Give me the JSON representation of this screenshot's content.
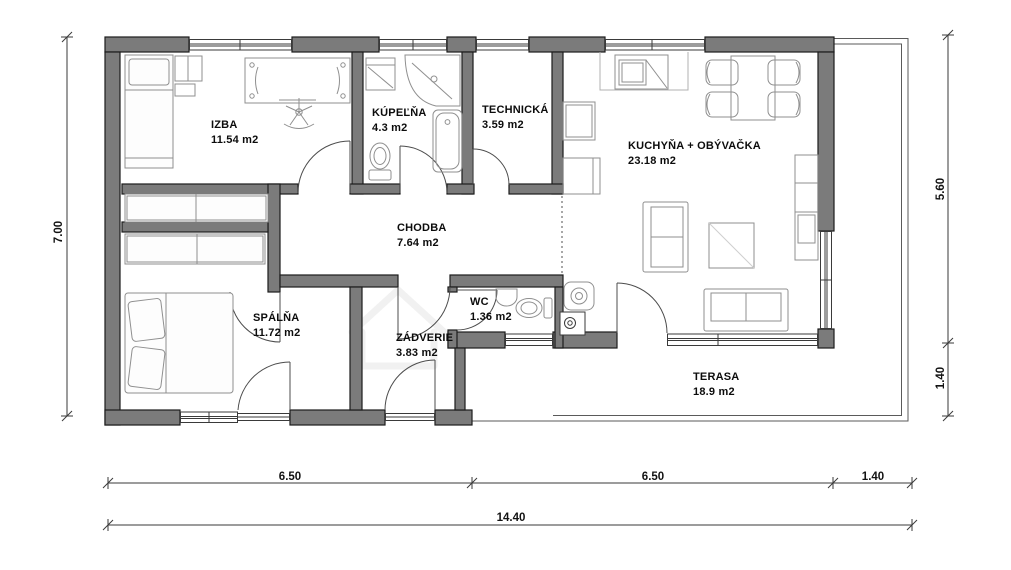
{
  "plan": {
    "title": "family-house floor plan",
    "rooms": [
      {
        "id": "izba",
        "name": "IZBA",
        "area": "11.54 m2"
      },
      {
        "id": "kupelna",
        "name": "KÚPEĽŇA",
        "area": "4.3 m2"
      },
      {
        "id": "technicka",
        "name": "TECHNICKÁ",
        "area": "3.59 m2"
      },
      {
        "id": "kuchyna",
        "name": "KUCHYŇA + OBÝVAČKA",
        "area": "23.18 m2"
      },
      {
        "id": "chodba",
        "name": "CHODBA",
        "area": "7.64 m2"
      },
      {
        "id": "spalna",
        "name": "SPÁLŇA",
        "area": "11.72 m2"
      },
      {
        "id": "wc",
        "name": "WC",
        "area": "1.36 m2"
      },
      {
        "id": "zadverie",
        "name": "ZÁDVERIE",
        "area": "3.83 m2"
      },
      {
        "id": "terasa",
        "name": "TERASA",
        "area": "18.9 m2"
      }
    ],
    "dimensions": {
      "left_height": "7.00",
      "right_upper": "5.60",
      "right_lower": "1.40",
      "bottom_left": "6.50",
      "bottom_middle": "6.50",
      "bottom_right": "1.40",
      "bottom_total": "14.40"
    },
    "colors": {
      "wall": "#7b7b7b",
      "wall_outline": "#1c1c1c",
      "furniture_line": "#8f8f8f",
      "window_line": "#3a3a3a",
      "dimension_line": "#3a3a3a",
      "background": "#ffffff"
    }
  }
}
